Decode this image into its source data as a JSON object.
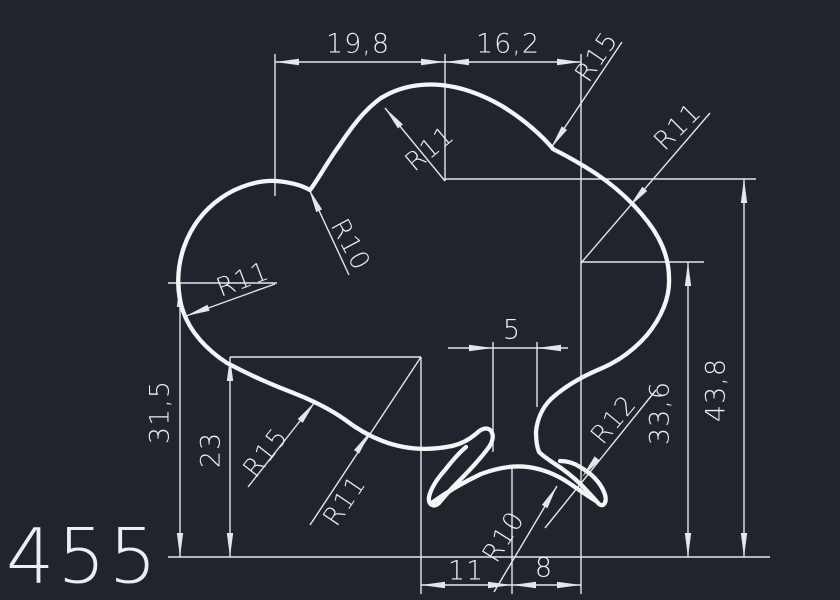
{
  "meta": {
    "type": "cad-technical-drawing",
    "part_number": "455"
  },
  "colors": {
    "background": "#20252d",
    "dimension_line": "#e4e7ea",
    "profile_line": "#f4f5f6",
    "text": "#eceef0"
  },
  "labels": {
    "dim_19_8": "19,8",
    "dim_16_2": "16,2",
    "r15_top_right": "R15",
    "r11_top_right": "R11",
    "r11_top_center": "R11",
    "r10_top_left": "R10",
    "r11_left": "R11",
    "dim_31_5": "31,5",
    "dim_23": "23",
    "r15_bottom_left": "R15",
    "r11_bottom_left": "R11",
    "dim_5": "5",
    "r12_right": "R12",
    "r10_bottom": "R10",
    "dim_33_6": "33,6",
    "dim_43_8": "43,8",
    "dim_11": "11",
    "dim_8": "8",
    "part_number": "455"
  }
}
